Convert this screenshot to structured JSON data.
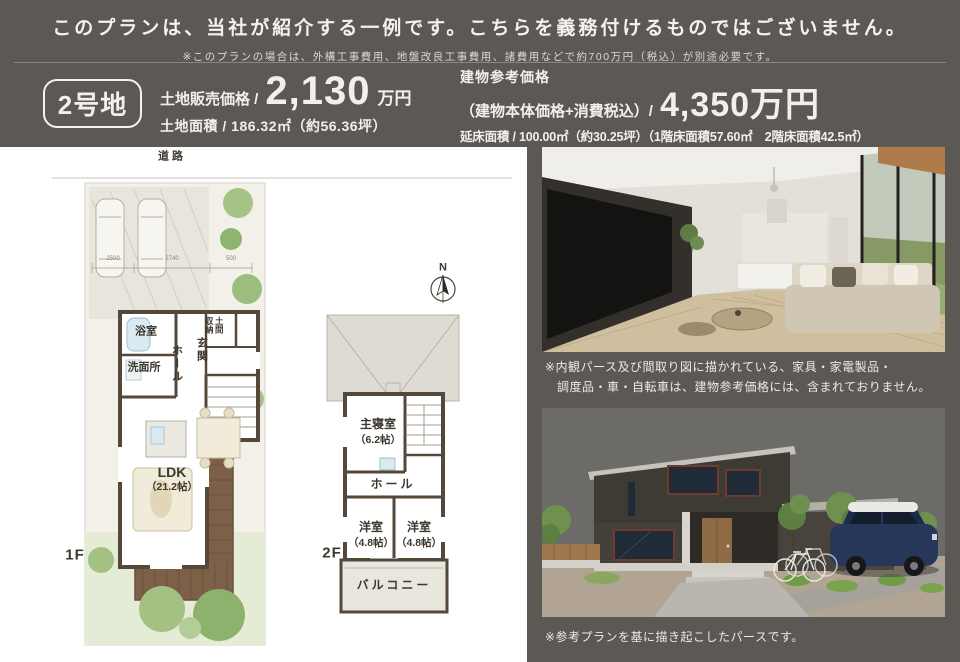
{
  "banner": {
    "title": "このプランは、当社が紹介する一例です。こちらを義務付けるものではございません。",
    "note": "※このプランの場合は、外構工事費用、地盤改良工事費用、諸費用などで約700万円（税込）が別途必要です。"
  },
  "header": {
    "badge": "2号地",
    "land": {
      "price_label": "土地販売価格 /",
      "price_value": "2,130",
      "price_unit": "万円",
      "area_line": "土地面積 / 186.32㎡（約56.36坪）"
    },
    "building": {
      "label": "建物参考価格",
      "sub_label": "（建物本体価格+消費税込）/",
      "price_value": "4,350万円",
      "area_line": "延床面積 / 100.00㎡（約30.25坪）（1階床面積57.60㎡　2階床面積42.5㎡）"
    }
  },
  "plan": {
    "road": "道路",
    "f1": "1F",
    "f2": "2F",
    "compass": "N",
    "dims": {
      "d1": "2500",
      "d2": "2740",
      "d3": "500"
    },
    "r1f": {
      "bath": "浴室",
      "wash": "洗面所",
      "hall": "ホール",
      "entry": "玄関",
      "doma_right": "土間",
      "doma_left": "収納",
      "ldk": "LDK",
      "ldk_size": "（21.2帖）"
    },
    "r2f": {
      "master": "主寝室",
      "master_size": "（6.2帖）",
      "hall": "ホール",
      "room1": "洋室",
      "room1_size": "（4.8帖）",
      "room2": "洋室",
      "room2_size": "（4.8帖）",
      "balcony": "バルコニー"
    }
  },
  "captions": {
    "interior_line1": "※内観パース及び間取り図に描かれている、家具・家電製品・",
    "interior_line2": "調度品・車・自転車は、建物参考価格には、含まれておりません。",
    "exterior": "※参考プランを基に描き起こしたパースです。"
  },
  "colors": {
    "background": "#5c5955",
    "panel": "#ffffff",
    "text_light": "#f2f0ec",
    "plan_wall": "#55473a",
    "deck": "#7c6047",
    "lawn": "#e5ecd6",
    "roof": "#dddbd2"
  }
}
